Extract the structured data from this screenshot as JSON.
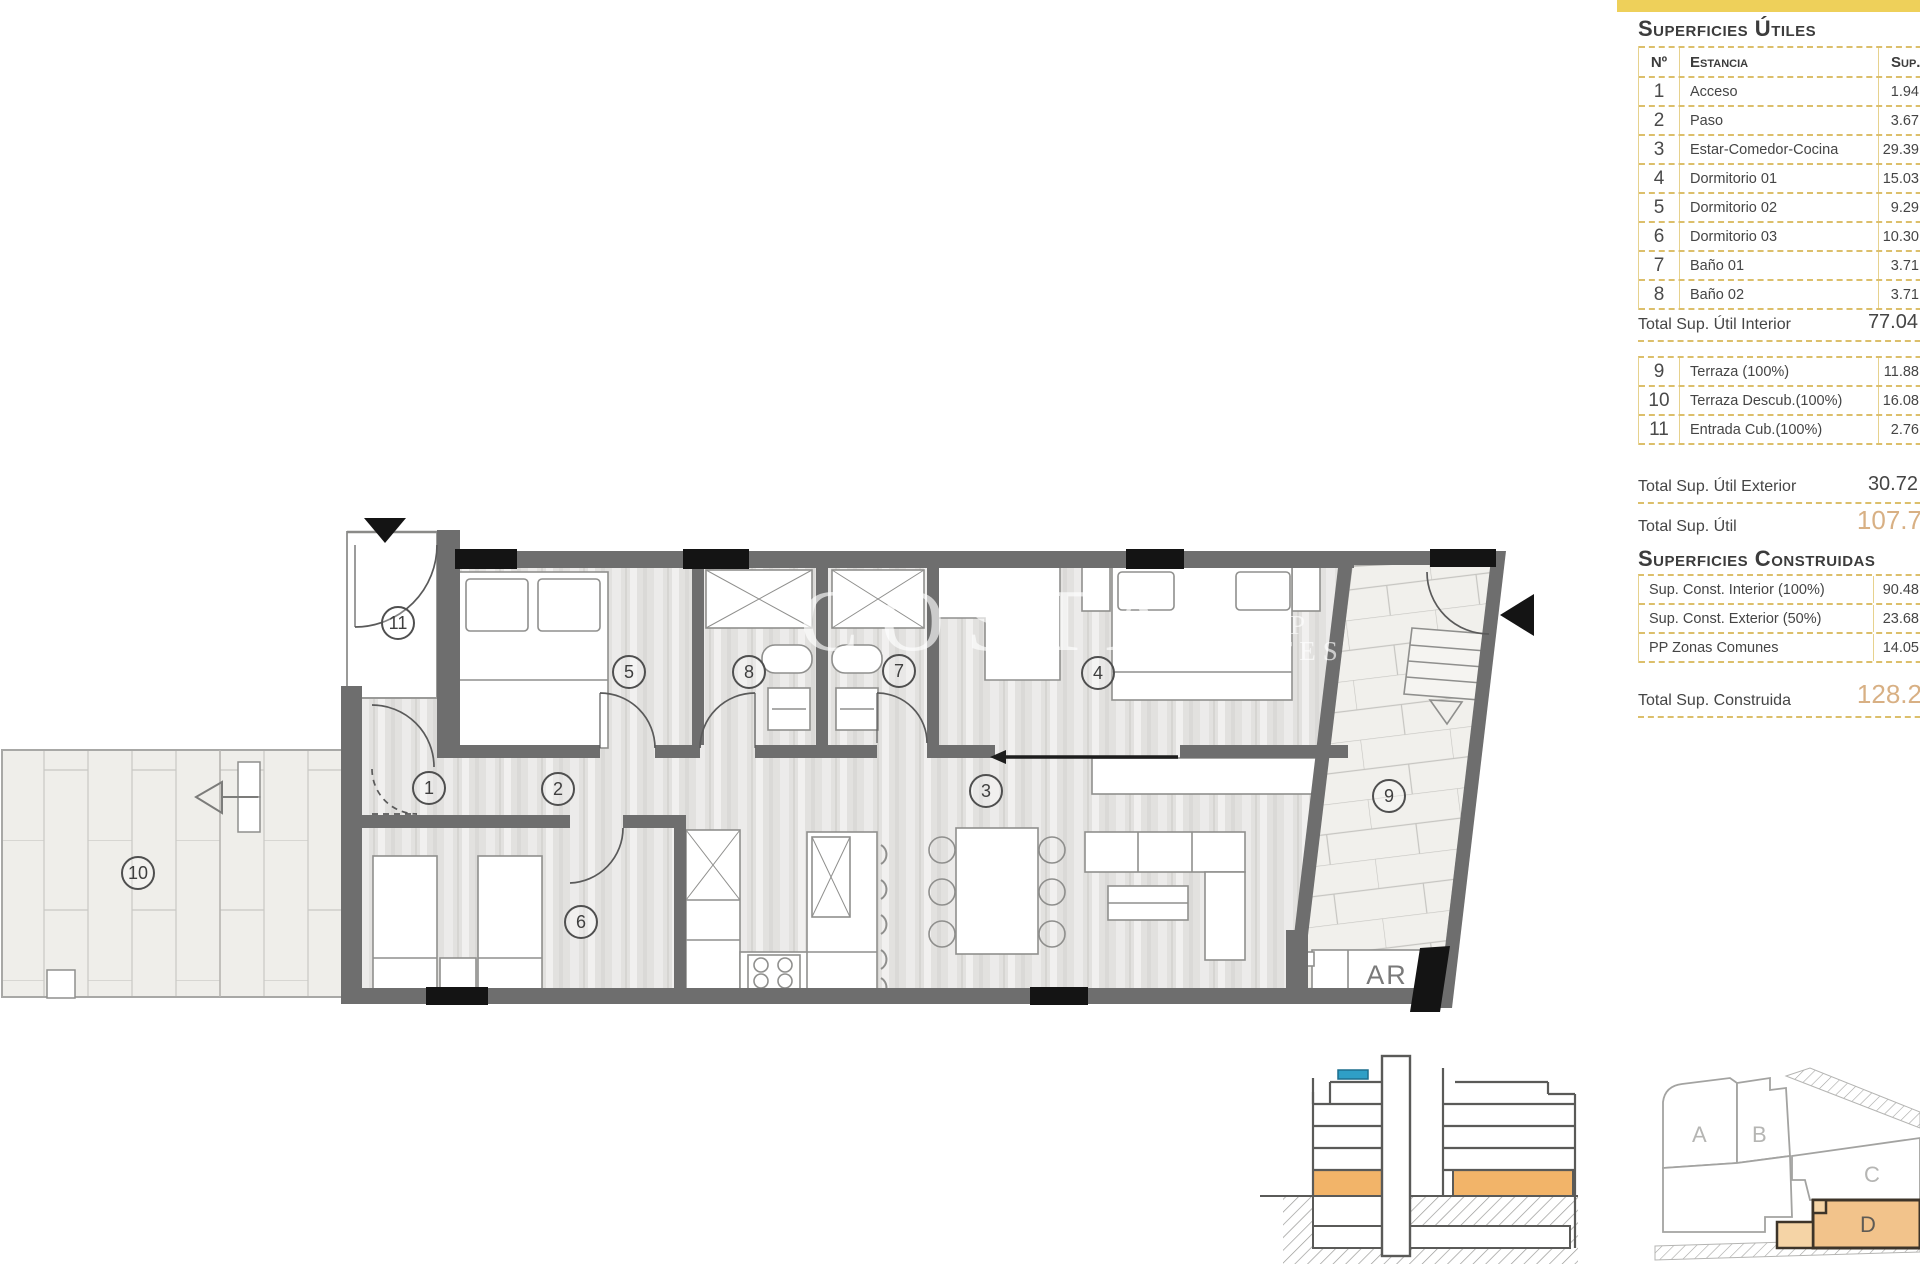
{
  "panel": {
    "title_utiles": "Superficies Útiles",
    "col_n": "Nº",
    "col_estancia": "Estancia",
    "col_sup": "Sup. Útil",
    "rows_utiles": [
      {
        "n": "1",
        "name": "Acceso",
        "value": "1.94"
      },
      {
        "n": "2",
        "name": "Paso",
        "value": "3.67"
      },
      {
        "n": "3",
        "name": "Estar-Comedor-Cocina",
        "value": "29.39"
      },
      {
        "n": "4",
        "name": "Dormitorio 01",
        "value": "15.03"
      },
      {
        "n": "5",
        "name": "Dormitorio 02",
        "value": "9.29"
      },
      {
        "n": "6",
        "name": "Dormitorio 03",
        "value": "10.30"
      },
      {
        "n": "7",
        "name": "Baño 01",
        "value": "3.71"
      },
      {
        "n": "8",
        "name": "Baño 02",
        "value": "3.71"
      }
    ],
    "total_interior_label": "Total Sup. Útil Interior",
    "total_interior_value": "77.04",
    "rows_exterior": [
      {
        "n": "9",
        "name": "Terraza (100%)",
        "value": "11.88"
      },
      {
        "n": "10",
        "name": "Terraza Descub.(100%)",
        "value": "16.08"
      },
      {
        "n": "11",
        "name": "Entrada Cub.(100%)",
        "value": "2.76"
      }
    ],
    "total_exterior_label": "Total Sup. Útil Exterior",
    "total_exterior_value": "30.72",
    "total_util_label": "Total Sup. Útil",
    "total_util_value": "107.7",
    "title_construidas": "Superficies Construidas",
    "rows_construidas": [
      {
        "name": "Sup. Const. Interior (100%)",
        "value": "90.48"
      },
      {
        "name": "Sup. Const. Exterior (50%)",
        "value": "23.68"
      },
      {
        "name": "PP Zonas Comunes",
        "value": "14.05"
      }
    ],
    "total_construida_label": "Total Sup. Construida",
    "total_construida_value": "128.2"
  },
  "plan": {
    "rooms": [
      {
        "num": "1"
      },
      {
        "num": "2"
      },
      {
        "num": "3"
      },
      {
        "num": "4"
      },
      {
        "num": "5"
      },
      {
        "num": "6"
      },
      {
        "num": "7"
      },
      {
        "num": "8"
      },
      {
        "num": "9"
      },
      {
        "num": "10"
      },
      {
        "num": "11"
      }
    ],
    "ar_label": "AR",
    "watermark": {
      "word": "COSTA",
      "line1": "GROUP",
      "line2": "ESTATES"
    }
  },
  "site": {
    "blocks": [
      {
        "label": "A"
      },
      {
        "label": "B"
      },
      {
        "label": "C"
      },
      {
        "label": "D"
      }
    ]
  },
  "colors": {
    "gold_bar": "#eed05a",
    "dash_border": "#dcbf6b",
    "total_orange": "#d8b084",
    "wall_gray": "#6e6e6e",
    "highlight_orange": "#f2b469",
    "marker_blue": "#2f9fc6",
    "site_block_orange": "#f2c38b"
  }
}
